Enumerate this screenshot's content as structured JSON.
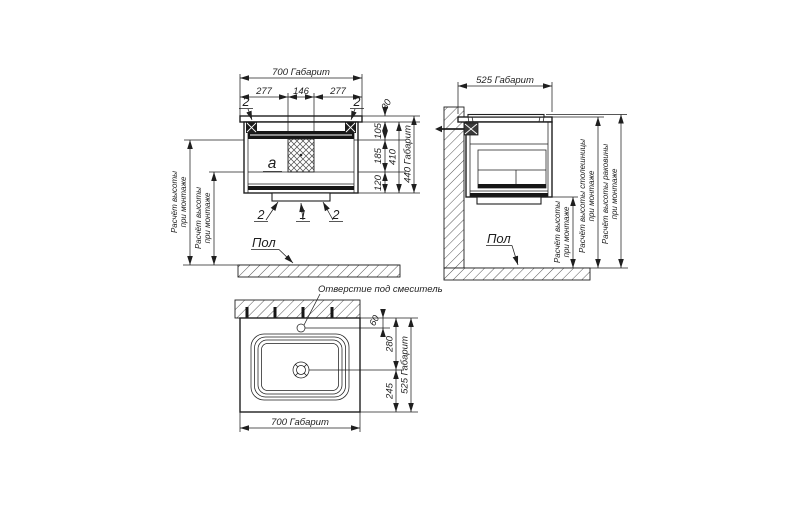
{
  "ink_color": "#1f1f1f",
  "paper_color": "#ffffff",
  "front_view": {
    "width_dim": "700 Габарит",
    "seg_left": "277",
    "seg_center": "146",
    "seg_right": "277",
    "h30": "30",
    "h105": "105",
    "h185": "185",
    "h120": "120",
    "h410": "410",
    "h440": "440 Габарит",
    "callout_top_left": "2",
    "callout_top_right": "2",
    "callout_bottom_left": "2",
    "callout_bottom_center": "1",
    "callout_bottom_right": "2",
    "section_label": "a",
    "mount_height_line1": "Расчёт высоты",
    "mount_height_line2": "при монтаже",
    "floor_label": "Пол"
  },
  "side_view": {
    "width_dim": "525 Габарит",
    "floor_label": "Пол",
    "mount_height_line1": "Расчёт высоты",
    "mount_height_line2": "при монтаже",
    "countertop_height_line1": "Расчёт высоты столешницы",
    "countertop_height_line2": "при монтаже",
    "basin_height_line1": "Расчёт высоты раковины",
    "basin_height_line2": "при монтаже"
  },
  "top_view": {
    "faucet_hole_label": "Отверстие под смеситель",
    "d60": "60",
    "d280": "280",
    "d245": "245",
    "depth_dim": "525 Габарит",
    "width_dim": "700 Габарит"
  }
}
